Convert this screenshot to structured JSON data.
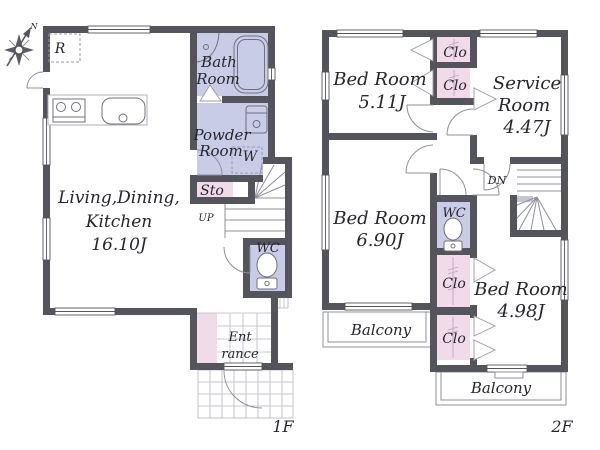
{
  "compass": {
    "n": "N"
  },
  "floor1": {
    "label": "1F",
    "ldk": {
      "line1": "Living,Dining,",
      "line2": "Kitchen",
      "line3": "16.10J"
    },
    "bath": {
      "line1": "Bath",
      "line2": "Room"
    },
    "powder": {
      "line1": "Powder",
      "line2": "Room"
    },
    "washer": "W",
    "sto": "Sto",
    "up": "UP",
    "wc": "WC",
    "entrance": {
      "line1": "Ent",
      "line2": "rance"
    },
    "fridge": "R"
  },
  "floor2": {
    "label": "2F",
    "bed1": {
      "line1": "Bed Room",
      "line2": "5.11J"
    },
    "service": {
      "line1": "Service",
      "line2": "Room",
      "line3": "4.47J"
    },
    "clo1": "Clo",
    "clo2": "Clo",
    "clo3": "Clo",
    "clo4": "Clo",
    "dn": "DN",
    "wc": "WC",
    "bed2": {
      "line1": "Bed Room",
      "line2": "6.90J"
    },
    "bed3": {
      "line1": "Bed Room",
      "line2": "4.98J"
    },
    "balcony1": "Balcony",
    "balcony2": "Balcony"
  },
  "colors": {
    "wall": "#54545c",
    "wet_room_fill": "#c9cce6",
    "closet_fill": "#f2dbe9",
    "text": "#26262e"
  }
}
